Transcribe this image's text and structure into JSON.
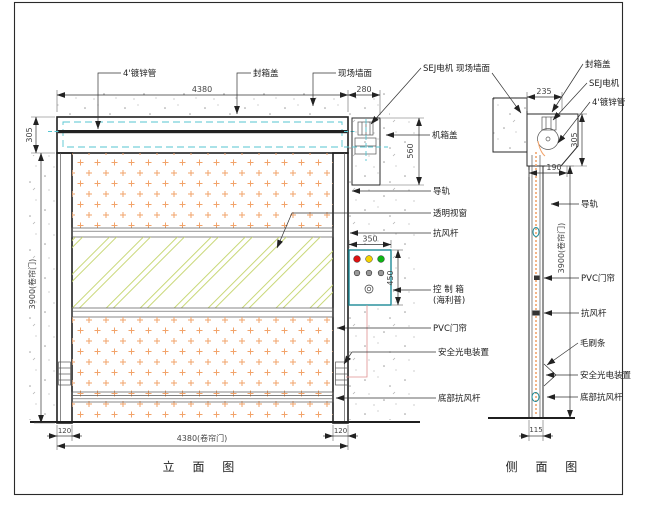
{
  "colors": {
    "line": "#1f1f1f",
    "cyan_dash": "#54c6d2",
    "dot_orange": "#f2a36a",
    "glass_green": "#c3d46a",
    "control_border": "#1d8a96",
    "light_red": "#dd1111",
    "light_yellow": "#f4d300",
    "light_green": "#0db414",
    "wire_red": "#e09090"
  },
  "elevation": {
    "title": "立 面 图",
    "leaders": {
      "pipe": "4'镀锌管",
      "box_cover": "封箱盖",
      "wall": "现场墙面",
      "motor": "SEJ电机",
      "machine_cover": "机箱盖",
      "rail": "导轨",
      "window": "透明视窗",
      "wind_bar": "抗风杆",
      "control_box_line1": "控 制 箱",
      "control_box_line2": "(海利普)",
      "pvc": "PVC门帘",
      "safety": "安全光电装置",
      "bottom_bar": "底部抗风杆"
    },
    "dims": {
      "width_top": "4380",
      "right_top": "280",
      "header_h": "305",
      "motor_h": "560",
      "door_h": "3900(卷帘门)",
      "cb_w": "350",
      "cb_h": "450",
      "rail_left": "120",
      "rail_right": "120",
      "width_bottom": "4380(卷帘门)"
    }
  },
  "side": {
    "title": "侧 面 图",
    "leaders": {
      "wall": "现场墙面",
      "box_cover": "封箱盖",
      "motor": "SEJ电机",
      "pipe": "4'镀锌管",
      "rail": "导轨",
      "pvc": "PVC门帘",
      "wind_bar": "抗风杆",
      "brush": "毛刷条",
      "safety": "安全光电装置",
      "bottom_bar": "底部抗风杆"
    },
    "dims": {
      "top": "235",
      "box_h": "305",
      "offset": "190",
      "door_h": "3900(卷帘门)",
      "bottom": "115"
    }
  }
}
